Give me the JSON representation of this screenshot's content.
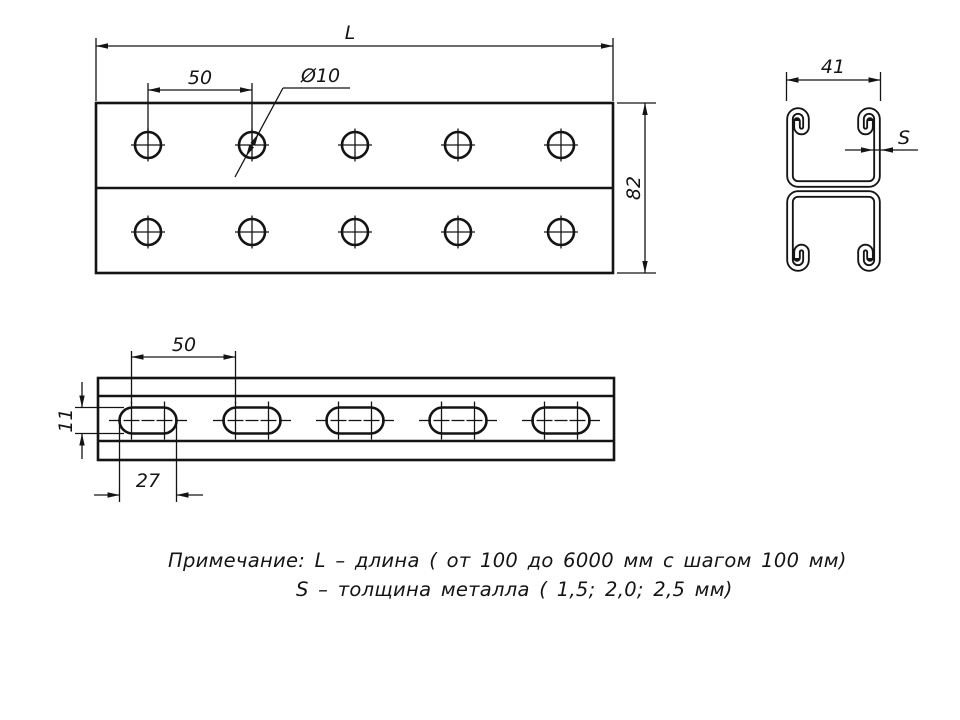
{
  "drawing": {
    "background": "#ffffff",
    "line_color": "#141414",
    "dims": {
      "length": "L",
      "hole_pitch": "50",
      "hole_dia": "Ø10",
      "height": "82",
      "width": "41",
      "thickness": "S",
      "slot_pitch": "50",
      "slot_length": "27",
      "slot_width": "11"
    },
    "note": {
      "line1": "Примечание: L – длина ( от 100 до 6000 мм с шагом 100 мм)",
      "line2": "S – толщина металла ( 1,5; 2,0; 2,5 мм)"
    }
  }
}
